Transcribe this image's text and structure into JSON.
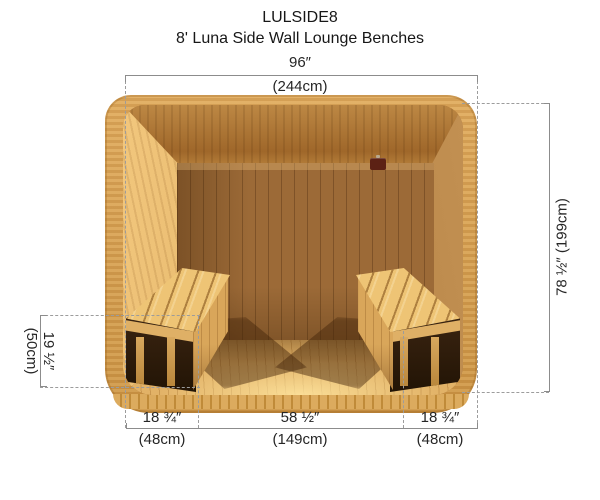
{
  "header": {
    "product_code": "LULSIDE8",
    "product_name": "8' Luna Side Wall Lounge Benches"
  },
  "dims": {
    "top": {
      "in": "96″",
      "cm": "(244cm)"
    },
    "right": {
      "label": "78 ½″ (199cm)"
    },
    "left": {
      "in": "19 ½″",
      "cm": "(50cm)"
    },
    "bottom": [
      {
        "in": "18 ¾″",
        "cm": "(48cm)"
      },
      {
        "in": "58 ½″",
        "cm": "(149cm)"
      },
      {
        "in": "18 ¾″",
        "cm": "(48cm)"
      }
    ]
  },
  "illustration": {
    "description": "Cutaway front view of sauna interior with lounge benches along the left and right side walls"
  },
  "colors": {
    "exterior_wood": "#d7a052",
    "ceiling_wood": "#a96f2e",
    "back_wall_wood": "#9c6a37",
    "floor_wood": "#e2b267",
    "bench_wood": "#eec475",
    "under_bench_shadow": "#2a1a0a",
    "vent": "#5c2114",
    "dimension_line": "#8c8c8c",
    "text": "#1f1f1f"
  }
}
